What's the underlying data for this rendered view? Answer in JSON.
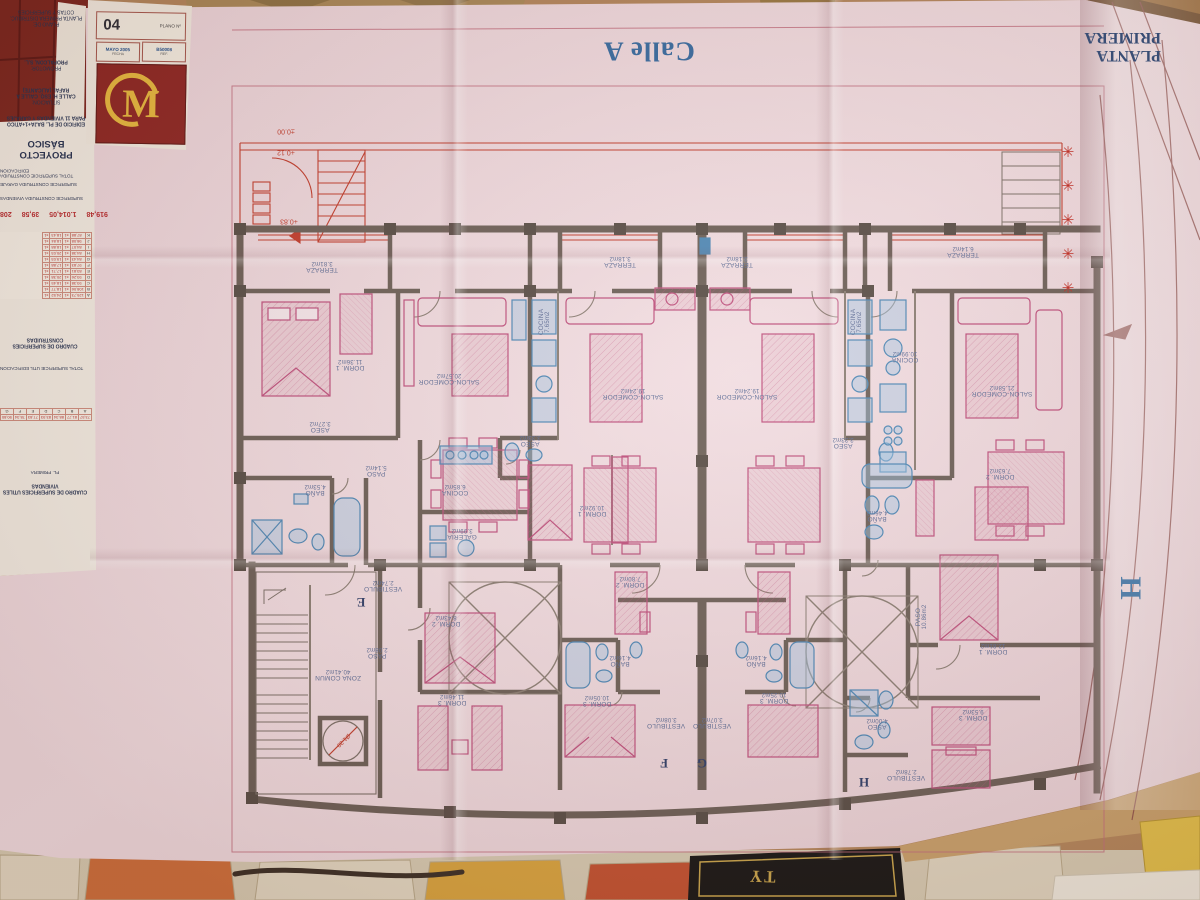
{
  "streets": {
    "calle_a": "Calle A",
    "calle_h_letter": "H"
  },
  "sheet_title": "PLANTA PRIMERA",
  "title_block": {
    "project_type": "PROYECTO BÁSICO",
    "building_line1": "EDIFICIO DE PL. BAJA+1+ATICO",
    "building_line2": "PARA 11 VIVIENDAS Y GARAJES",
    "situacion_label": "SITUACION:",
    "situacion_line1": "CALLE H, ESQ. CALLE A",
    "situacion_line2": "RAFAL (ALICANTE)",
    "promotor_label": "PROMOTOR:",
    "promotor": "PROPALCON, S.L.",
    "plano_de_label": "PLANO DE:",
    "plano_de_line1": "PLANTA PRIMERA DISTRIBUC.",
    "plano_de_line2": "COTAS Y SUPERFICIES",
    "plano_num_label": "PLANO Nº",
    "plano_num": "04",
    "fecha_label": "FECHA",
    "fecha": "MAYO 2005",
    "ref_label": "REF.",
    "ref": "B50008",
    "logo_letter": "M"
  },
  "tables": {
    "constructed": {
      "title": "CUADRO DE SUPERFICIES CONSTRUIDAS",
      "row_title_1": "TOTAL SUPERFICIE CONSTRUIDA EDIFICACION",
      "row_title_2": "SUPERFICIE CONSTRUIDA GARAJE",
      "row_title_3": "SUPERFICIE CONSTRUIDA VIVIENDAS",
      "totals": [
        "919,48",
        "1.014,05",
        "39,58",
        "208"
      ],
      "col_headers": [
        "VIVIENDA",
        "x",
        "TERRAZAS",
        "B. COMUNES"
      ],
      "rows": [
        {
          "id": "A",
          "v1": "125,73",
          "v2": "24,52"
        },
        {
          "id": "B",
          "v1": "108,06",
          "v2": "18,77"
        },
        {
          "id": "C",
          "v1": "93,38",
          "v2": "18,45"
        },
        {
          "id": "D",
          "v1": "93,26",
          "v2": "20,38"
        },
        {
          "id": "E",
          "v1": "83,81",
          "v2": "17,71"
        },
        {
          "id": "F",
          "v1": "97,83",
          "v2": "17,88"
        },
        {
          "id": "G",
          "v1": "84,43",
          "v2": "19,03"
        },
        {
          "id": "H",
          "v1": "84,38",
          "v2": "20,03"
        },
        {
          "id": "I",
          "v1": "84,07",
          "v2": "18,88"
        },
        {
          "id": "J",
          "v1": "98,08",
          "v2": "18,84"
        },
        {
          "id": "K",
          "v1": "87,88",
          "v2": "18,43"
        }
      ]
    },
    "useful": {
      "title": "CUADRO DE SUPERFICIES UTILES VIVIENDAS",
      "row_title_1": "TOTAL SUPERFICIE UTIL EDIFICACION",
      "letters": [
        "A",
        "B",
        "C",
        "D",
        "E",
        "F",
        "G",
        "H",
        "I"
      ],
      "values": [
        "73,57",
        "81,77",
        "88,34",
        "83,93",
        "77,83",
        "78,34",
        "90,80",
        "76,34",
        "71,57"
      ],
      "row_label_1": "PL. BAJA",
      "row_label_2": "PL. PRIMERA",
      "col_label": "PLANTA"
    }
  },
  "plan": {
    "star_glyph": "✳",
    "stars": [
      {
        "x": 1068,
        "y": 152
      },
      {
        "x": 1068,
        "y": 186
      },
      {
        "x": 1068,
        "y": 220
      },
      {
        "x": 1068,
        "y": 254
      },
      {
        "x": 1068,
        "y": 288
      }
    ],
    "levels": [
      {
        "v": "±0.00",
        "x": 286,
        "y": 131
      },
      {
        "v": "+0.12",
        "x": 286,
        "y": 152
      },
      {
        "v": "+0.83",
        "x": 289,
        "y": 221
      }
    ],
    "elevator_dim": "Ø1.30",
    "letters": [
      {
        "ch": "E",
        "x": 361,
        "y": 602
      },
      {
        "ch": "F",
        "x": 664,
        "y": 763
      },
      {
        "ch": "G",
        "x": 702,
        "y": 763
      },
      {
        "ch": "H",
        "x": 864,
        "y": 782
      }
    ],
    "rooms": [
      {
        "t": "TERRAZA",
        "a": "3.81m2",
        "x": 322,
        "y": 266
      },
      {
        "t": "DORM. 1",
        "a": "11.36m2",
        "x": 350,
        "y": 364
      },
      {
        "t": "SALON-COMEDOR",
        "a": "20.57m2",
        "x": 449,
        "y": 378
      },
      {
        "t": "ASEO",
        "a": "3.27m2",
        "x": 320,
        "y": 426
      },
      {
        "t": "PASO",
        "a": "5.14m2",
        "x": 376,
        "y": 470
      },
      {
        "t": "BAÑO",
        "a": "4.53m2",
        "x": 315,
        "y": 489
      },
      {
        "t": "COCINA",
        "a": "6.85m2",
        "x": 455,
        "y": 489
      },
      {
        "t": "GALERIA",
        "a": "3.99m2",
        "x": 462,
        "y": 533
      },
      {
        "t": "TERRAZA",
        "a": "3.18m2",
        "x": 620,
        "y": 261
      },
      {
        "t": "TERRAZA",
        "a": "3.18m2",
        "x": 737,
        "y": 261
      },
      {
        "t": "COCINA",
        "a": "7.65m2",
        "x": 545,
        "y": 322,
        "rot": 90
      },
      {
        "t": "COCINA",
        "a": "7.65m2",
        "x": 857,
        "y": 322,
        "rot": 90
      },
      {
        "t": "SALON-COMEDOR",
        "a": "19.24m2",
        "x": 633,
        "y": 393
      },
      {
        "t": "SALON-COMEDOR",
        "a": "19.24m2",
        "x": 747,
        "y": 393
      },
      {
        "t": "ASEO",
        "a": "3.33m2",
        "x": 530,
        "y": 440
      },
      {
        "t": "ASEO",
        "a": "3.33m2",
        "x": 843,
        "y": 442
      },
      {
        "t": "TERRAZA",
        "a": "6.14m2",
        "x": 963,
        "y": 251
      },
      {
        "t": "COCINA",
        "a": "10.99m2",
        "x": 905,
        "y": 356
      },
      {
        "t": "SALON-COMEDOR",
        "a": "21.58m2",
        "x": 1002,
        "y": 390
      },
      {
        "t": "DORM. 1",
        "a": "10.92m2",
        "x": 592,
        "y": 510
      },
      {
        "t": "DORM. 2",
        "a": "7.80m2",
        "x": 630,
        "y": 581
      },
      {
        "t": "BAÑO",
        "a": "4.46m2",
        "x": 877,
        "y": 515
      },
      {
        "t": "DORM. 2",
        "a": "7.63m2",
        "x": 1000,
        "y": 473
      },
      {
        "t": "PASO",
        "a": "10.86m2",
        "x": 922,
        "y": 617,
        "rot": 90
      },
      {
        "t": "DORM. 1",
        "a": "12.81m2",
        "x": 993,
        "y": 648
      },
      {
        "t": "DORM. 3",
        "a": "9.53m2",
        "x": 973,
        "y": 714
      },
      {
        "t": "ASEO",
        "a": "4.00m2",
        "x": 877,
        "y": 723
      },
      {
        "t": "VESTIBULO",
        "a": "2.78m2",
        "x": 906,
        "y": 774
      },
      {
        "t": "VESTIBULO",
        "a": "2.74m2",
        "x": 383,
        "y": 585
      },
      {
        "t": "DORM. 2",
        "a": "8.43m2",
        "x": 446,
        "y": 620
      },
      {
        "t": "PASO",
        "a": "2.08m2",
        "x": 377,
        "y": 652
      },
      {
        "t": "ZONA COMUN",
        "a": "40.41m2",
        "x": 338,
        "y": 674
      },
      {
        "t": "DORM. 3",
        "a": "11.46m2",
        "x": 452,
        "y": 699
      },
      {
        "t": "BAÑO",
        "a": "4.16m2",
        "x": 620,
        "y": 660
      },
      {
        "t": "BAÑO",
        "a": "4.16m2",
        "x": 756,
        "y": 660
      },
      {
        "t": "DORM. 3",
        "a": "10.05m2",
        "x": 597,
        "y": 700
      },
      {
        "t": "DORM. 3",
        "a": "10.25m2",
        "x": 774,
        "y": 697
      },
      {
        "t": "VESTIBULO",
        "a": "3.08m2",
        "x": 666,
        "y": 722
      },
      {
        "t": "VESTIBULO",
        "a": "3.07m2",
        "x": 712,
        "y": 722
      }
    ]
  },
  "floor_objects": {
    "book_text": "TY"
  }
}
